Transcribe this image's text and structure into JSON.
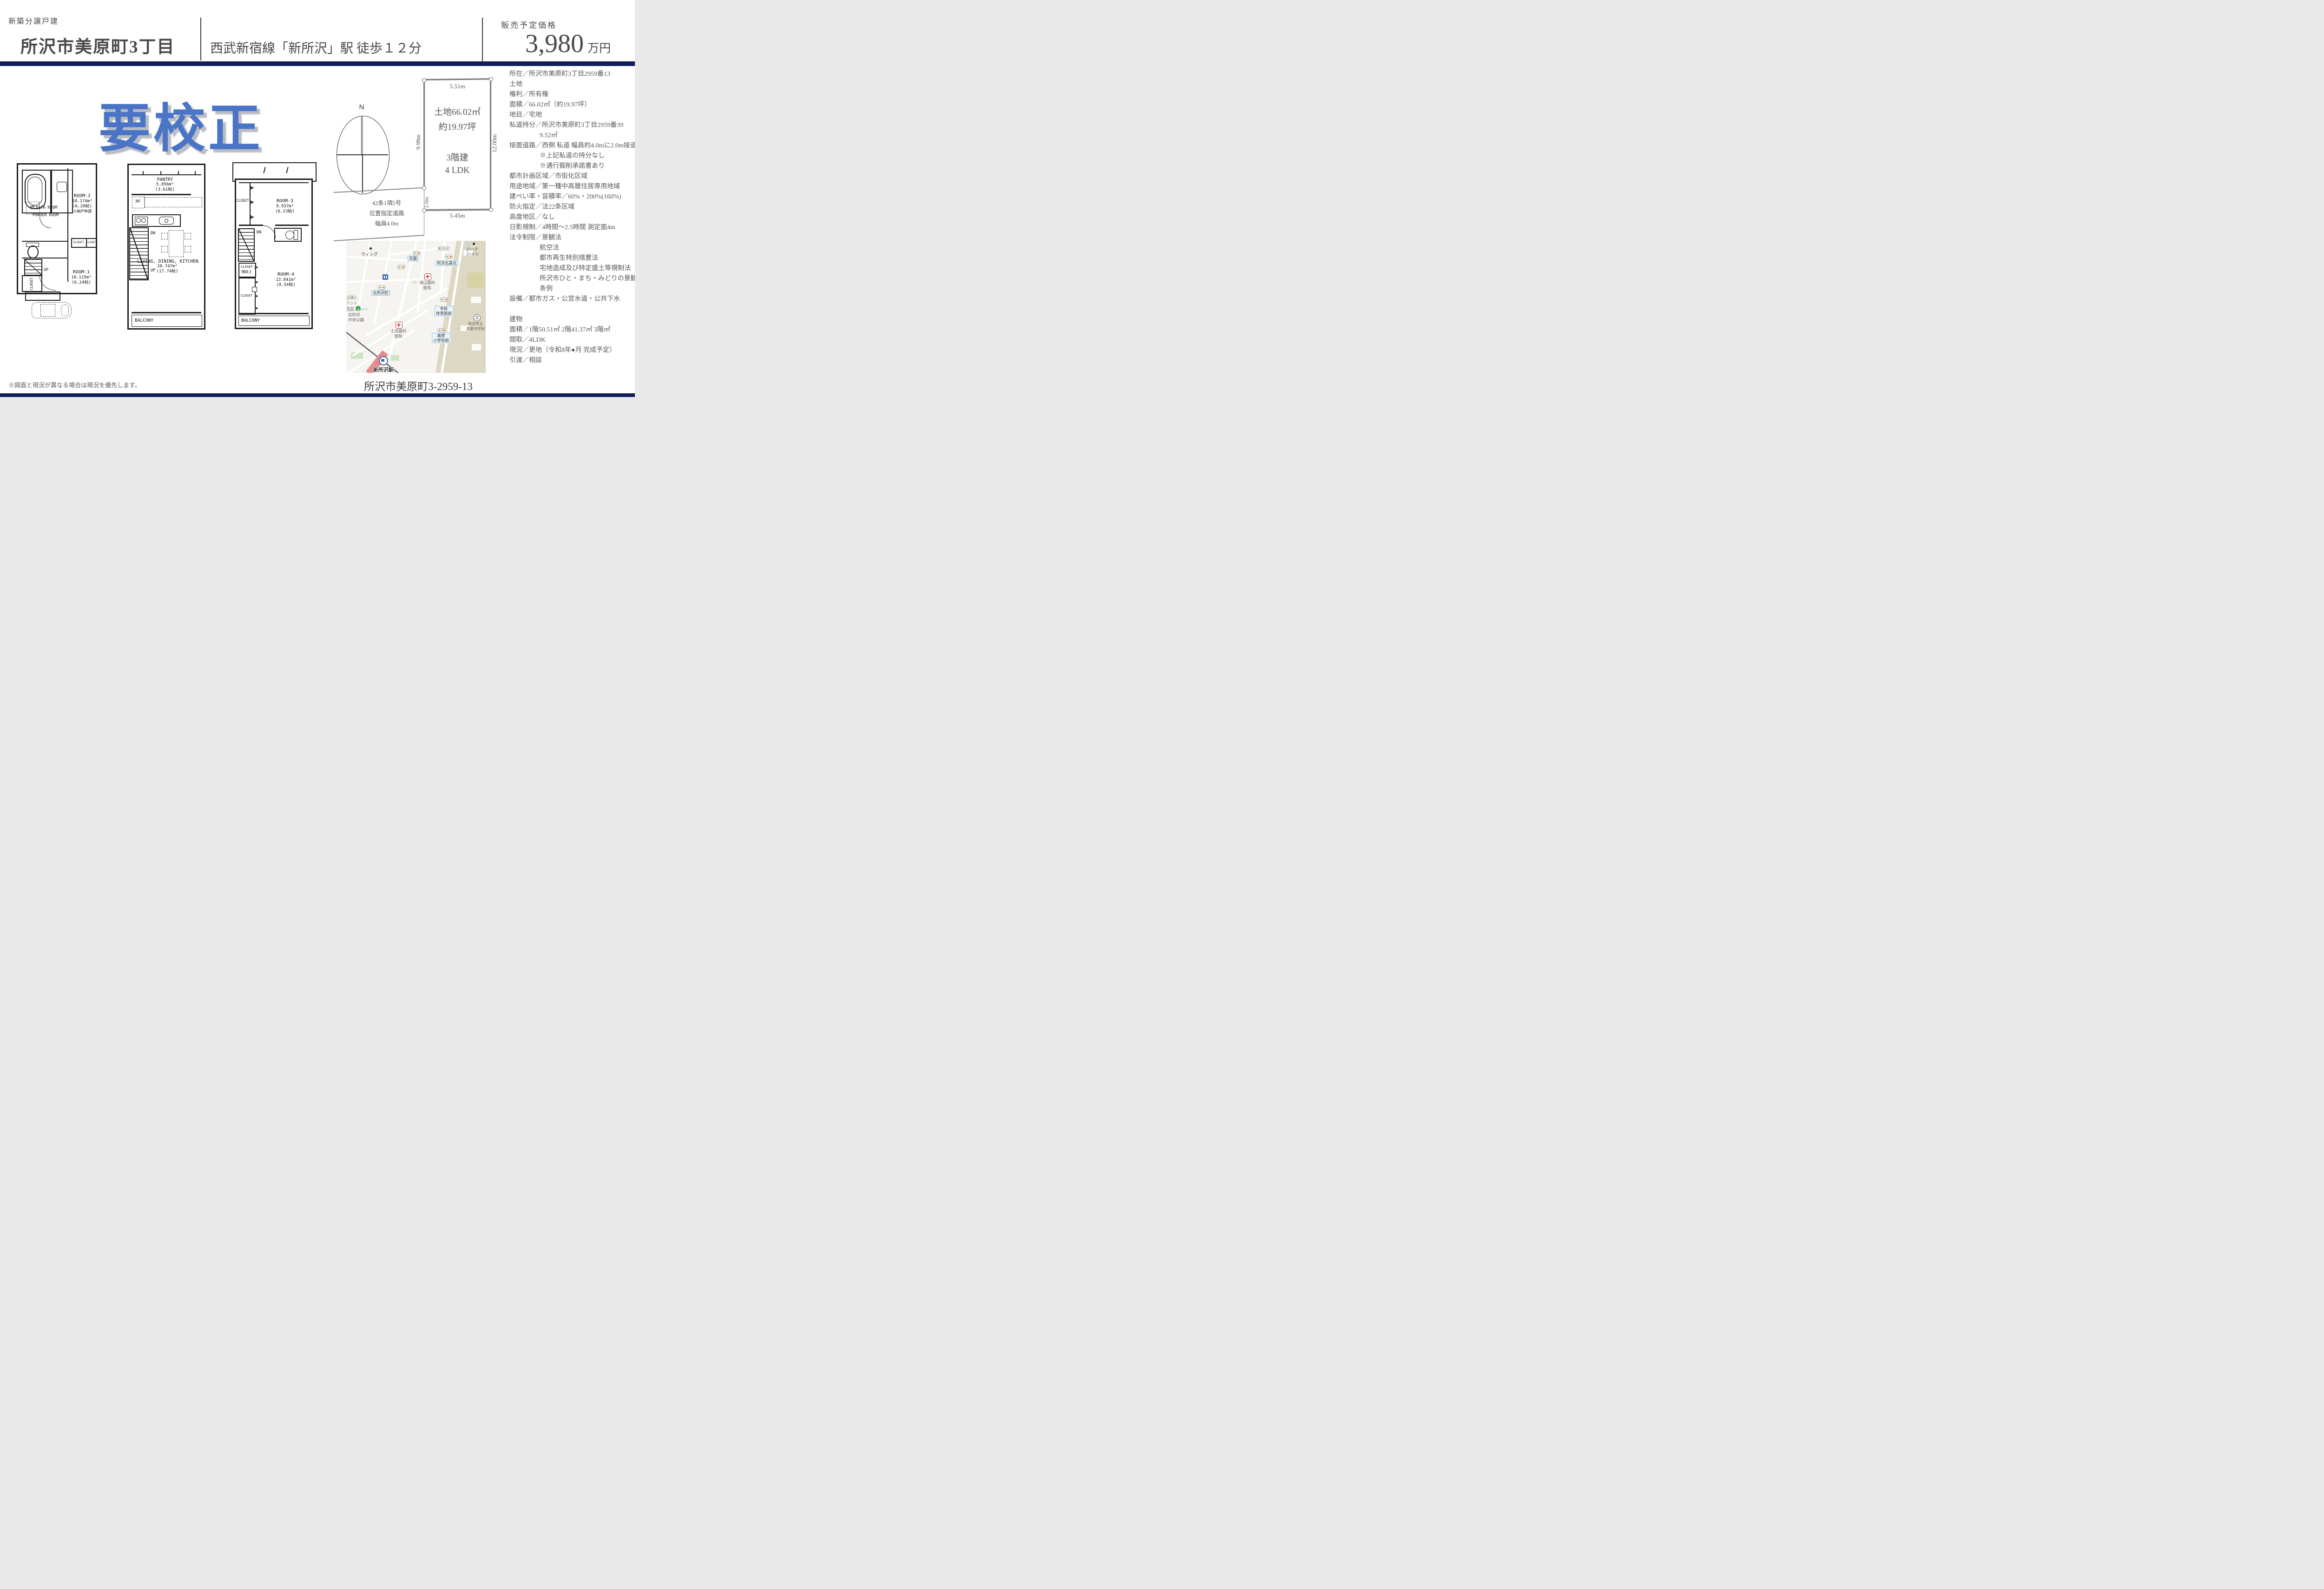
{
  "header": {
    "category": "新築分譲戸建",
    "title": "所沢市美原町3丁目",
    "station_line": "西武新宿線「新所沢」駅 徒歩１２分",
    "price_label": "販売予定価格",
    "price_value": "3,980",
    "price_unit": "万円"
  },
  "watermark": {
    "text": "要校正",
    "color": "#4a74c6"
  },
  "floorplans": {
    "fp1": {
      "bathroom": "BATH ROOM",
      "wm": "WM",
      "powder": "POWDER ROOM",
      "room2_1": "ROOM-2",
      "room2_2": "10.174m²",
      "room2_3": "(6.28帖)",
      "room2_4": "※納戸申請",
      "closet_a": "CLOSET",
      "closet_b": "CLOSET",
      "closet_c": "CLOSET",
      "up": "UP",
      "room1_1": "ROOM-1",
      "room1_2": "10.115m²",
      "room1_3": "(6.24帖)"
    },
    "fp2": {
      "pantry_1": "PANTRY",
      "pantry_2": "5.856m²",
      "pantry_3": "(3.61帖)",
      "rf": "RF",
      "dn": "DN",
      "up": "UP",
      "ldk_1": "LIVING, DINING, KITCHEN",
      "ldk_2": "28.747m²",
      "ldk_3": "(17.74帖)",
      "balcony": "BALCONY"
    },
    "fp3": {
      "closet_top": "CLOSET",
      "room3_1": "ROOM-3",
      "room3_2": "9.937m²",
      "room3_3": "(6.13帖)",
      "dn": "DN",
      "closet_st1": "CLOSET",
      "closet_st2": "階段上",
      "closet_low": "CLOSET",
      "room4_1": "ROOM-4",
      "room4_2": "13.841m²",
      "room4_3": "(8.54帖)",
      "balcony": "BALCONY"
    }
  },
  "siteplan": {
    "north": "N",
    "dim_top": "5.51m",
    "dim_left": "9.98m",
    "dim_right": "12.00m",
    "dim_bottom": "5.45m",
    "dim_frontage": "2.0m",
    "area_line1": "土地66.02㎡",
    "area_line2": "約19.97坪",
    "floors": "3階建",
    "layout": "4 LDK",
    "road_1": "42条1項5号",
    "road_2": "位置指定道路",
    "road_3": "幅員4.0m"
  },
  "map": {
    "caption": "所沢市美原町3-2959-13",
    "labels": {
      "wing": "ウィング",
      "mihara_cho": "美原町",
      "park1": "パーク",
      "park2": "ハイツ",
      "hanazono": "花園",
      "tokorozawa_kita_north": "所沢北高北",
      "suyama1": "須山歯科",
      "suyama2": "医院",
      "kita_tokorozawa": "北所沢町",
      "frag1": "止法人",
      "frag2": "アンド",
      "frag3": "育園",
      "shimin1": "市民",
      "shimin2": "体育館前",
      "chuo1": "北所沢",
      "chuo2": "中央公園",
      "tsuchida1": "土田歯科",
      "tsuchida2": "医院",
      "mihara_sho1": "美原",
      "mihara_sho2": "小学校前",
      "chugaku1": "所沢市立",
      "chugaku2": "美原中学校",
      "school_glyph": "文",
      "station": "新所沢駅"
    }
  },
  "details": {
    "lines": [
      {
        "t": "所在／所沢市美原町3丁目2959番13"
      },
      {
        "t": "土地"
      },
      {
        "t": "権利／所有権"
      },
      {
        "t": "面積／66.02㎡（約19.97坪）"
      },
      {
        "t": "地目／宅地"
      },
      {
        "t": "私道持分／所沢市美原町3丁目2959番39"
      },
      {
        "t": "9.52㎡"
      },
      {
        "t": "接面道路／西側 私道 幅員約4.0mに2.0m接道"
      },
      {
        "t": "※上記私道の持分なし"
      },
      {
        "t": "※通行掘削承諾書あり"
      },
      {
        "t": "都市計画区域／市街化区域"
      },
      {
        "t": "用途地域／第一種中高層住居専用地域"
      },
      {
        "t": "建ぺい率・容積率／60%・200%(160%)"
      },
      {
        "t": "防火指定／法22条区域"
      },
      {
        "t": "高度地区／なし"
      },
      {
        "t": "日影規制／4時間～2.5時間 測定面4m"
      },
      {
        "t": "法令制限／景観法"
      },
      {
        "t": "航空法"
      },
      {
        "t": "都市再生特別措置法"
      },
      {
        "t": "宅地造成及び特定盛土等規制法"
      },
      {
        "t": "所沢市ひと・まち・みどりの景観"
      },
      {
        "t": "条例"
      },
      {
        "t": "設備／都市ガス・公営水道・公共下水"
      },
      {
        "t": ""
      },
      {
        "t": "建物"
      },
      {
        "t": "面積／1階50.51㎡ 2階41.37㎡ 3階㎡"
      },
      {
        "t": "間取／4LDK"
      },
      {
        "t": "現況／更地（令和8年●月 完成予定）"
      },
      {
        "t": "引渡／相談"
      }
    ]
  },
  "note": "※図面と現況が異なる場合は現況を優先します。"
}
